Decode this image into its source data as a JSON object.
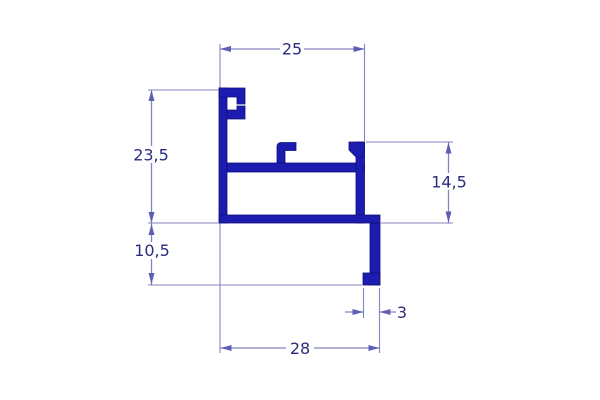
{
  "colors": {
    "profile": "#1c1cb0",
    "profile-edge": "#10107a",
    "dim-line": "#8484c2",
    "dim-arrow": "#5e5eb2",
    "dim-text": "#2c2c7e",
    "background": "#ffffff"
  },
  "dimensions": {
    "top_width": "25",
    "upper_left_height": "23,5",
    "lower_left_height": "10,5",
    "right_height": "14,5",
    "bottom_tab_width": "3",
    "bottom_width": "28"
  }
}
